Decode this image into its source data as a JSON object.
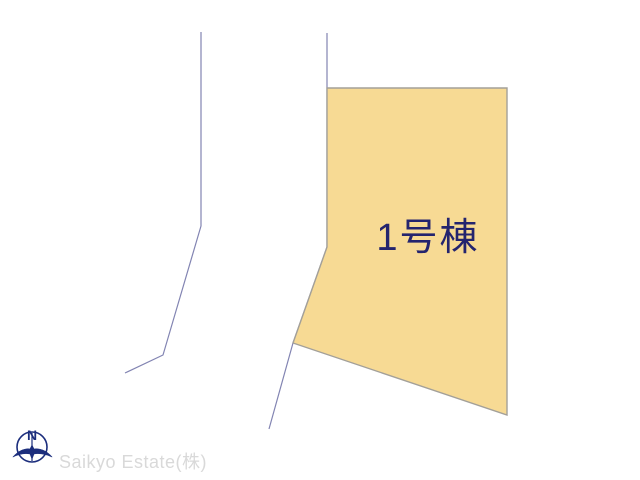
{
  "lot": {
    "label": "1号棟",
    "points": "327,88 507,88 507,415 293,343 327,247"
  },
  "roads": {
    "left_points": "201,32 201,226 163,355 125,373",
    "right_points": "327,33 327,247 293,343 269,429"
  },
  "compass": {
    "north_label": "N"
  },
  "watermark": {
    "text": "Saikyo Estate(株)"
  },
  "colors": {
    "background": "#FFFFFF",
    "lot_fill": "#F7DA94",
    "lot_border": "#A3A099",
    "road_line": "#8284B2",
    "lot_label": "#24246E",
    "compass": "#1C2E7D",
    "watermark": "#D9D9D9"
  }
}
